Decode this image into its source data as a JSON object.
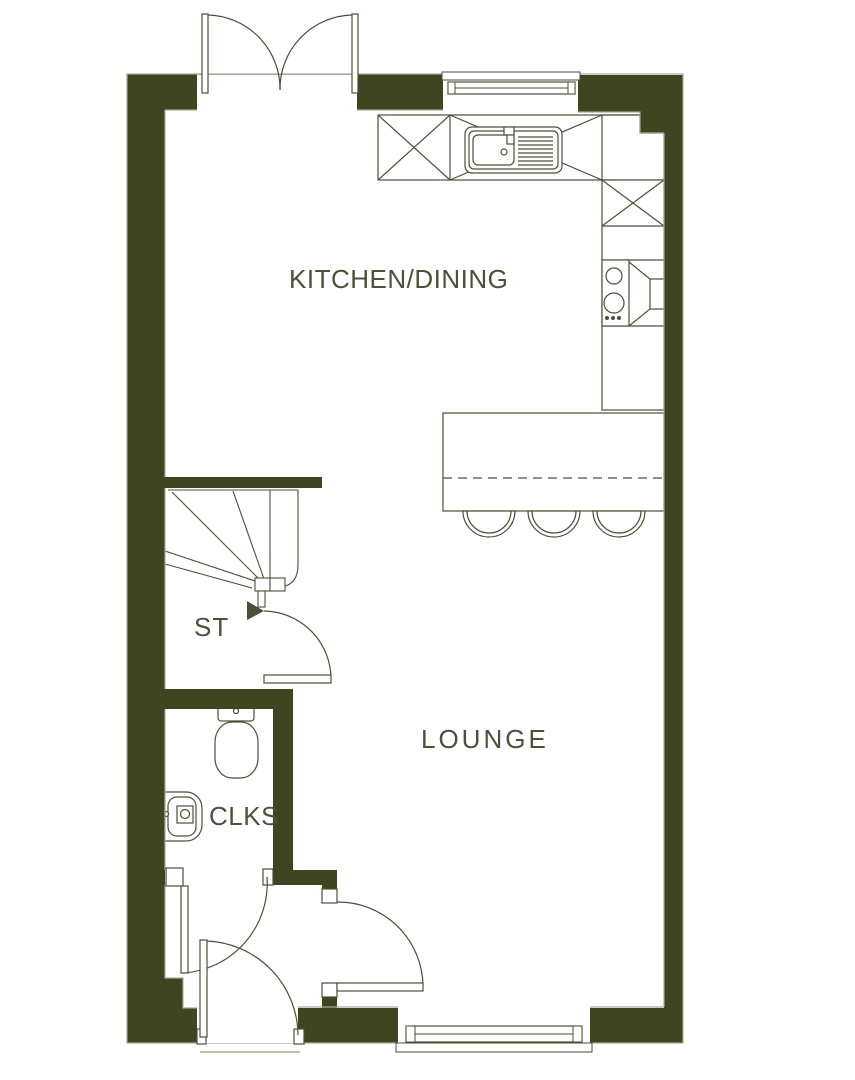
{
  "rooms": {
    "kitchen_dining": {
      "label": "KITCHEN/DINING"
    },
    "lounge": {
      "label": "LOUNGE"
    },
    "store": {
      "label": "ST"
    },
    "cloakroom": {
      "label": "CLKS"
    }
  },
  "colors": {
    "wall": "#3f4520",
    "line": "#4a5036",
    "inner_line": "#a9ac96",
    "label_text": "#4b5038",
    "background": "#ffffff"
  },
  "fixtures": [
    "french-doors",
    "kitchen-window",
    "kitchen-counter",
    "kitchen-sink",
    "hob",
    "extractor",
    "breakfast-bar",
    "bar-stools",
    "winder-stairs",
    "understairs-door",
    "toilet",
    "wash-basin",
    "cloakroom-door",
    "entrance-hall",
    "front-door",
    "lounge-door",
    "lounge-window"
  ]
}
